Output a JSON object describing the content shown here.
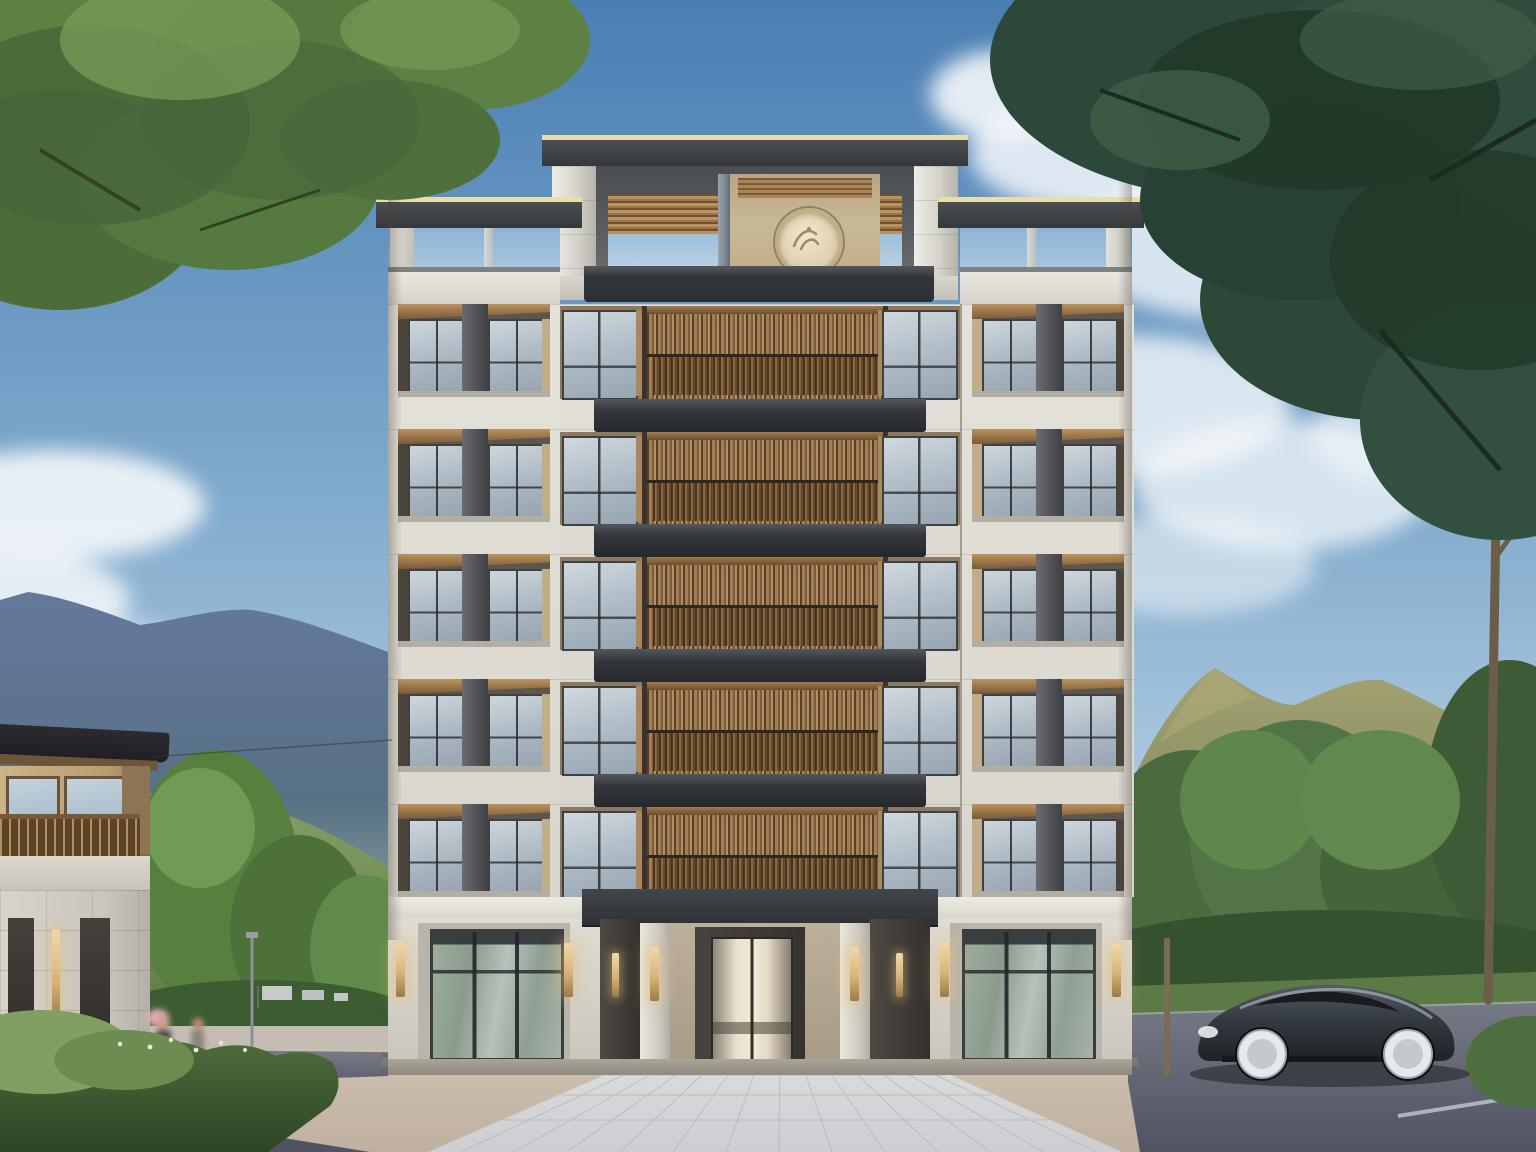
{
  "scene": {
    "description": "daytime architectural exterior rendering of a symmetric six-story residence with wood-louver balconies, flanked by a two-story annex, mountains, trees, plaza, pedestrians with a bicycle and a dark sedan",
    "main_building": {
      "wing_window_floors": 5,
      "center_balcony_floors": 5,
      "balcony_style": "vertical wood louver screens",
      "tower": "central parapet tower with round cream medallion and horizontal wood louvers",
      "ground_floor": "central glass double-door entrance with stone pillars, brass sconces and two glass storefronts",
      "sconce_count": 8
    },
    "secondary_building": {
      "position": "left edge",
      "stories": 2,
      "style": "wood upper floor, stone base, dark eave roof"
    },
    "vehicle": {
      "type": "sedan",
      "color_name": "dark gray",
      "location": "right road",
      "wheels": "bright silver"
    },
    "pedestrians": {
      "count": 2,
      "location": "left sidewalk",
      "accessory": "bicycle with basket"
    },
    "environment": [
      "blue-gray mountain ridge left",
      "olive green hills right",
      "large tree canopies top corners",
      "street trees",
      "hedge bottom left",
      "paved center walkway",
      "asphalt roads",
      "clouds"
    ]
  },
  "palette": {
    "sky-top": "#4a7fb4",
    "sky-mid": "#7fa9cc",
    "sky-low": "#bdd5e6",
    "stone": "#dedbd3",
    "stone-band": "#e0ddd5",
    "stone-dark": "#c6c3ba",
    "frame-dark": "#47494c",
    "canopy-dark": "#2e3135",
    "wood": "#9b7449",
    "wood-light": "#bb925f",
    "wood-dark": "#6e5132",
    "glass-a": "#cdd6dd",
    "glass-b": "#aab7c1",
    "glass-frame": "#3e4043",
    "interior-warm": "#f2ead8",
    "brass": "#d9b477",
    "beige-wall": "#bdb09a",
    "panel-dark": "#3e3a36",
    "mullion-gray": "#515356",
    "roofline-pale": "#e7deab",
    "mountain-blue": "#64799b",
    "hill-olive": "#9a9a6e",
    "hill-green": "#6e8a55",
    "tree-green": "#55793f",
    "tree-deep": "#2c483a",
    "hedge-green": "#415c33",
    "plaza-tan": "#cabcab",
    "path-gray": "#d8d9db",
    "road-gray": "#5b5f6d",
    "car-gray": "#343a41",
    "wheel-silver": "#e6e9ec"
  }
}
